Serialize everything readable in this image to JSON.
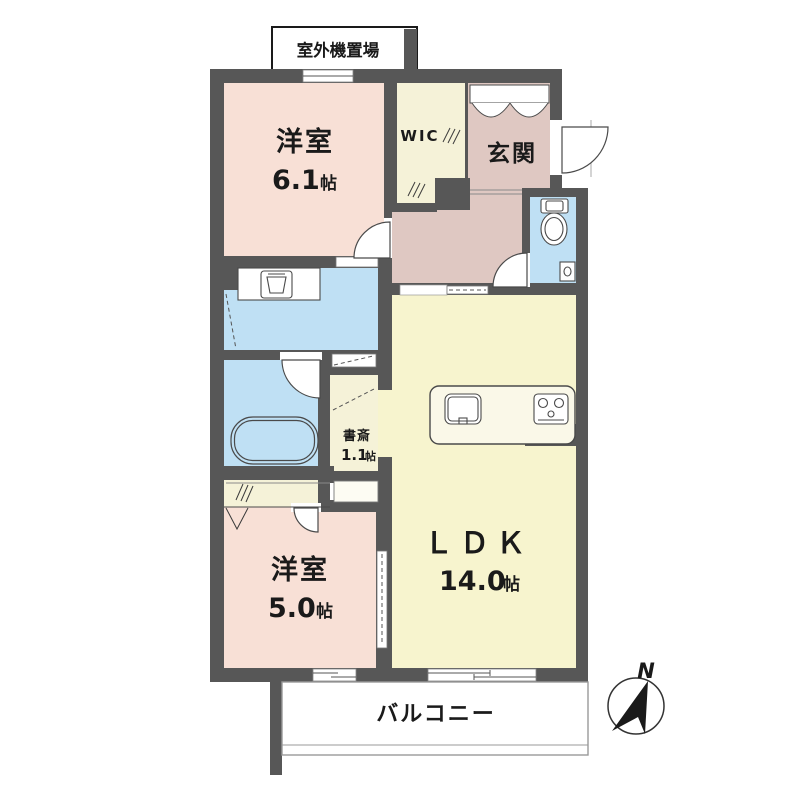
{
  "plan_labels": {
    "outdoor_unit": "室外機置場",
    "balcony": "バルコニー",
    "compass_north": "N"
  },
  "rooms": {
    "bedroom_upper": {
      "name": "洋室",
      "area": "6.1",
      "unit": "帖"
    },
    "wic": {
      "name": "WIC"
    },
    "entrance": {
      "name": "玄関"
    },
    "ldk": {
      "name": "ＬＤＫ",
      "area": "14.0",
      "unit": "帖"
    },
    "study": {
      "name": "書斎",
      "area": "1.1",
      "unit": "帖"
    },
    "bedroom_lower": {
      "name": "洋室",
      "area": "5.0",
      "unit": "帖"
    }
  },
  "colors": {
    "wall": "#575757",
    "bedroom_floor": "#F8E0D6",
    "entrance_floor": "#DFC8C2",
    "ldk_floor": "#F7F4CE",
    "closet_floor": "#F5F2D8",
    "wet_floor": "#BFE0F4",
    "counter": "#FAF8E8",
    "line": "#4A4A4A"
  }
}
